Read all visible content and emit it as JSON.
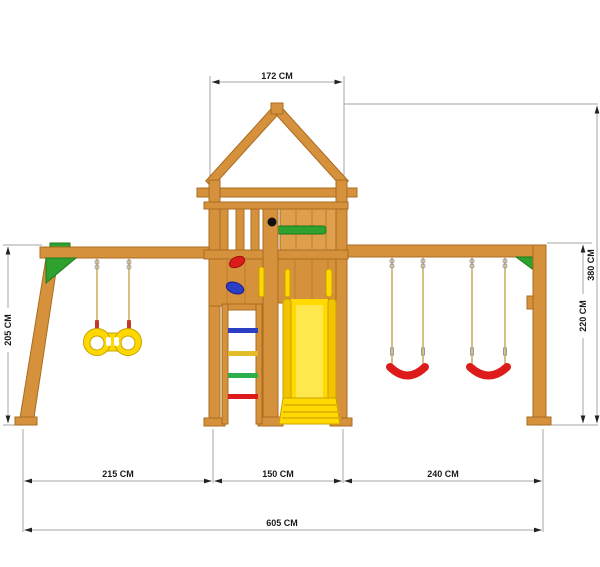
{
  "title": "Wooden playset dimensional diagram",
  "unit": "CM",
  "dimensions": {
    "top_width": "172 CM",
    "left_height": "205 CM",
    "total_height": "380 CM",
    "beam_height": "220 CM",
    "bottom_left": "215 CM",
    "bottom_center": "150 CM",
    "bottom_right": "240 CM",
    "total_width": "605 CM"
  },
  "colors": {
    "bg": "#FFFFFF",
    "wood": "#D6913C",
    "wood_dark": "#A96C22",
    "wood_light": "#DEA04C",
    "groove": "#B97F2E",
    "green": "#2FA12F",
    "green_dark": "#1E7A1E",
    "yellow": "#FFD800",
    "yellow_dark": "#C8A000",
    "slide_yellow": "#FFD900",
    "slide_rail": "#F2C400",
    "slide_shade": "#D9AE00",
    "slide_hi": "#FFE84D",
    "red": "#DD1B1B",
    "red_dark": "#A01010",
    "clip_red": "#C23A2A",
    "blue": "#2B3FC4",
    "blue_dark": "#1A1A90",
    "rung_yellow": "#E3BC2A",
    "rung_green": "#2FAE4C",
    "rope": "#C9A85C",
    "dim_line": "#A5A5A5",
    "ink": "#1A1A1A"
  }
}
